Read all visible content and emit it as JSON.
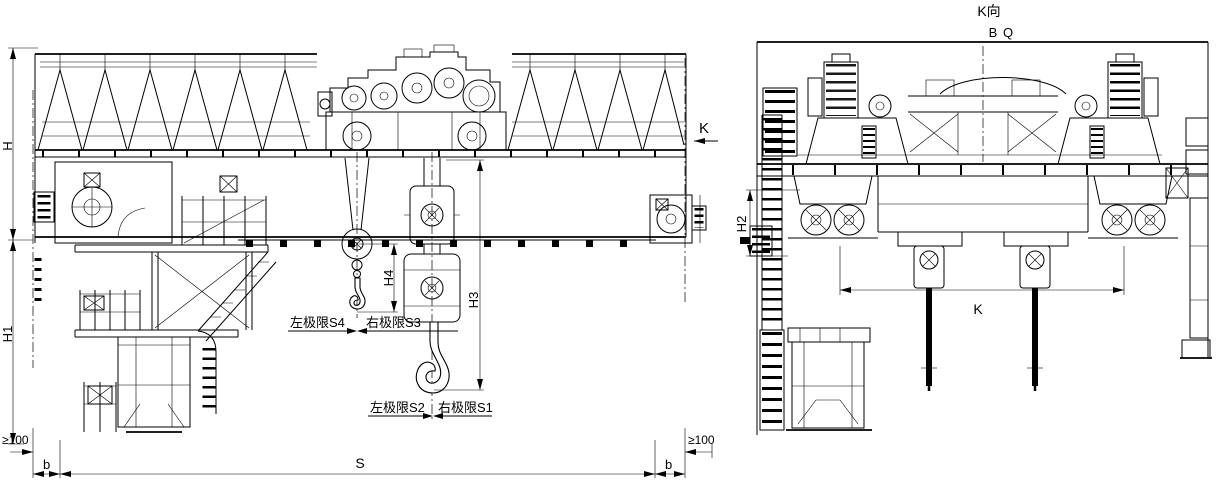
{
  "colors": {
    "line": "#000000",
    "background": "#ffffff"
  },
  "front_view": {
    "dims": {
      "h": "H",
      "h1": "H1",
      "h3": "H3",
      "h4": "H4",
      "s": "S",
      "b_left": "b",
      "b_right": "b",
      "min100_left": "≥100",
      "min100_right": "≥100",
      "k_arrow": "K"
    },
    "limits": {
      "aux_left": "左极限S4",
      "aux_right": "右极限S3",
      "main_left": "左极限S2",
      "main_right": "右极限S1"
    }
  },
  "side_view": {
    "title": "K向",
    "dims": {
      "b": "B",
      "q": "Q",
      "h2": "H2",
      "k": "K"
    }
  }
}
